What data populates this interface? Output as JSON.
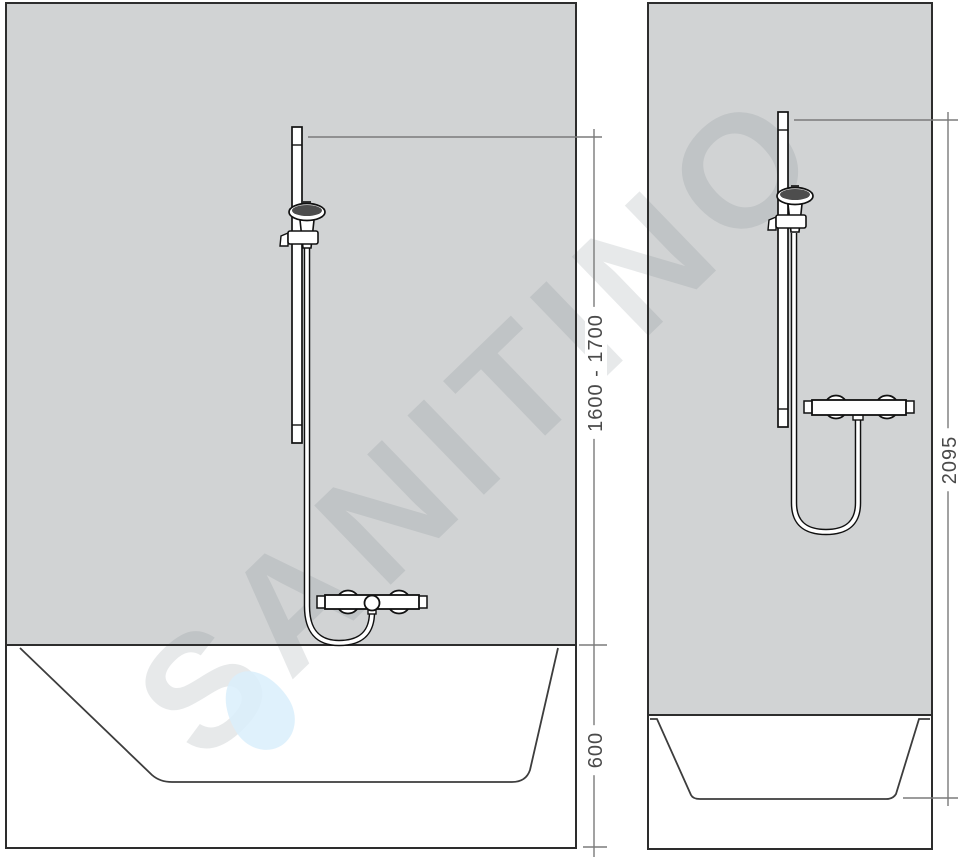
{
  "watermark": {
    "text": "SANITINO",
    "drop_color": "#d9effb"
  },
  "colors": {
    "background": "#ffffff",
    "wall_fill": "#d1d3d4",
    "panel_outline": "#2d2d2d",
    "fixture_stroke": "#111111",
    "basin_inner_stroke": "#3d3d3d",
    "dimension_line": "#7b7b7b",
    "dimension_text": "#4a4a4a"
  },
  "left_view": {
    "dimensions": [
      {
        "label": "1600 - 1700"
      },
      {
        "label": "600"
      }
    ]
  },
  "right_view": {
    "dimensions": [
      {
        "label": "2095"
      }
    ]
  }
}
